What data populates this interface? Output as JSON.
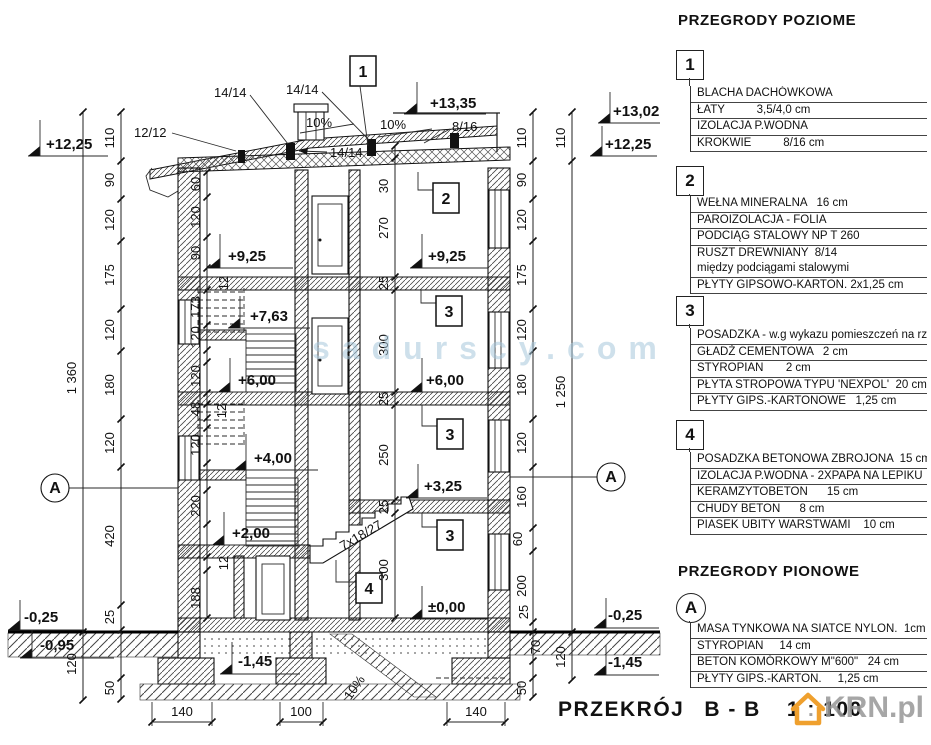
{
  "watermarks": {
    "center": "sadurscy.com",
    "brand": "KRN.pl"
  },
  "footer": {
    "title": "PRZEKRÓJ",
    "section": "B - B",
    "scale": "1 : 100"
  },
  "legend": {
    "horizontal_title": "PRZEGRODY POZIOME",
    "vertical_title": "PRZEGRODY PIONOWE",
    "items": [
      {
        "marker": "1",
        "rows": [
          "BLACHA DACHÓWKOWA",
          "ŁATY          3,5/4,0 cm",
          "IZOLACJA P.WODNA",
          "KROKWIE          8/16 cm"
        ]
      },
      {
        "marker": "2",
        "rows": [
          "WEŁNA MINERALNA   16 cm",
          "PAROIZOLACJA - FOLIA",
          "PODCIĄG STALOWY NP T 260",
          "RUSZT DREWNIANY  8/14",
          "między podciągami stalowymi",
          "PŁYTY GIPSOWO-KARTON. 2x1,25 cm"
        ]
      },
      {
        "marker": "3",
        "rows": [
          "POSADZKA - w.g wykazu pomieszczeń na rzucie",
          "GŁADŹ CEMENTOWA   2 cm",
          "STYROPIAN       2 cm",
          "PŁYTA STROPOWA TYPU 'NEXPOL'  20 cm",
          "PŁYTY GIPS.-KARTONOWE   1,25 cm"
        ]
      },
      {
        "marker": "4",
        "rows": [
          "POSADZKA BETONOWA ZBROJONA  15 cm",
          "IZOLACJA P.WODNA - 2XPAPA NA LEPIKU",
          "KERAMZYTOBETON      15 cm",
          "CHUDY BETON      8 cm",
          "PIASEK UBITY WARSTWAMI    10 cm"
        ]
      },
      {
        "marker": "A",
        "rows": [
          "MASA TYNKOWA NA SIATCE NYLON.  1cm",
          "STYROPIAN     14 cm",
          "BETON KOMÓRKOWY M\"600\"   24 cm",
          "PŁYTY GIPS.-KARTON.     1,25 cm"
        ]
      }
    ]
  },
  "drawing": {
    "roof": {
      "post1": "14/14",
      "post2": "14/14",
      "post3": "14/14",
      "batten": "12/12",
      "slope_left": "10%",
      "slope_right": "10%",
      "rafter": "8/16"
    },
    "levels": {
      "top": "+13,35",
      "attic": "+13,02",
      "parapet_right": "+12,25",
      "parapet_left": "+12,25",
      "floor3_left": "+9,25",
      "floor3_right": "+9,25",
      "landing_763": "+7,63",
      "floor2_left": "+6,00",
      "floor2_right": "+6,00",
      "landing_400": "+4,00",
      "floor1_right": "+3,25",
      "landing_200": "+2,00",
      "ground": "±0,00",
      "terrain_left": "-0,25",
      "cellar_left": "-0,95",
      "terrain_right": "-0,25",
      "footing_right": "-1,45",
      "footing_center": "-1,45"
    },
    "marks": {
      "roof_box": "1",
      "room2": "2",
      "room3a": "3",
      "room3b": "3",
      "room3c": "3",
      "room4": "4",
      "section_left": "A",
      "section_right": "A"
    },
    "stair_label": "7x18/27",
    "drain_slope": "10%",
    "dims": {
      "left_total": "1 360",
      "right_total": "1 250",
      "left": [
        "110",
        "90",
        "120",
        "175",
        "120",
        "180",
        "120",
        "420",
        "25",
        "120",
        "50"
      ],
      "right": [
        "110",
        "90",
        "120",
        "175",
        "120",
        "180",
        "120",
        "160",
        "60",
        "200",
        "25",
        "70",
        "50"
      ],
      "right_outer": [
        "110",
        "120"
      ],
      "inner_left": [
        "60",
        "120",
        "90",
        "12",
        "173",
        "120",
        "120",
        "48",
        "12",
        "120",
        "220",
        "12",
        "188"
      ],
      "inner_right": [
        "30",
        "270",
        "25",
        "300",
        "25",
        "250",
        "25",
        "300"
      ],
      "bottom": [
        "140",
        "100",
        "140"
      ]
    }
  }
}
